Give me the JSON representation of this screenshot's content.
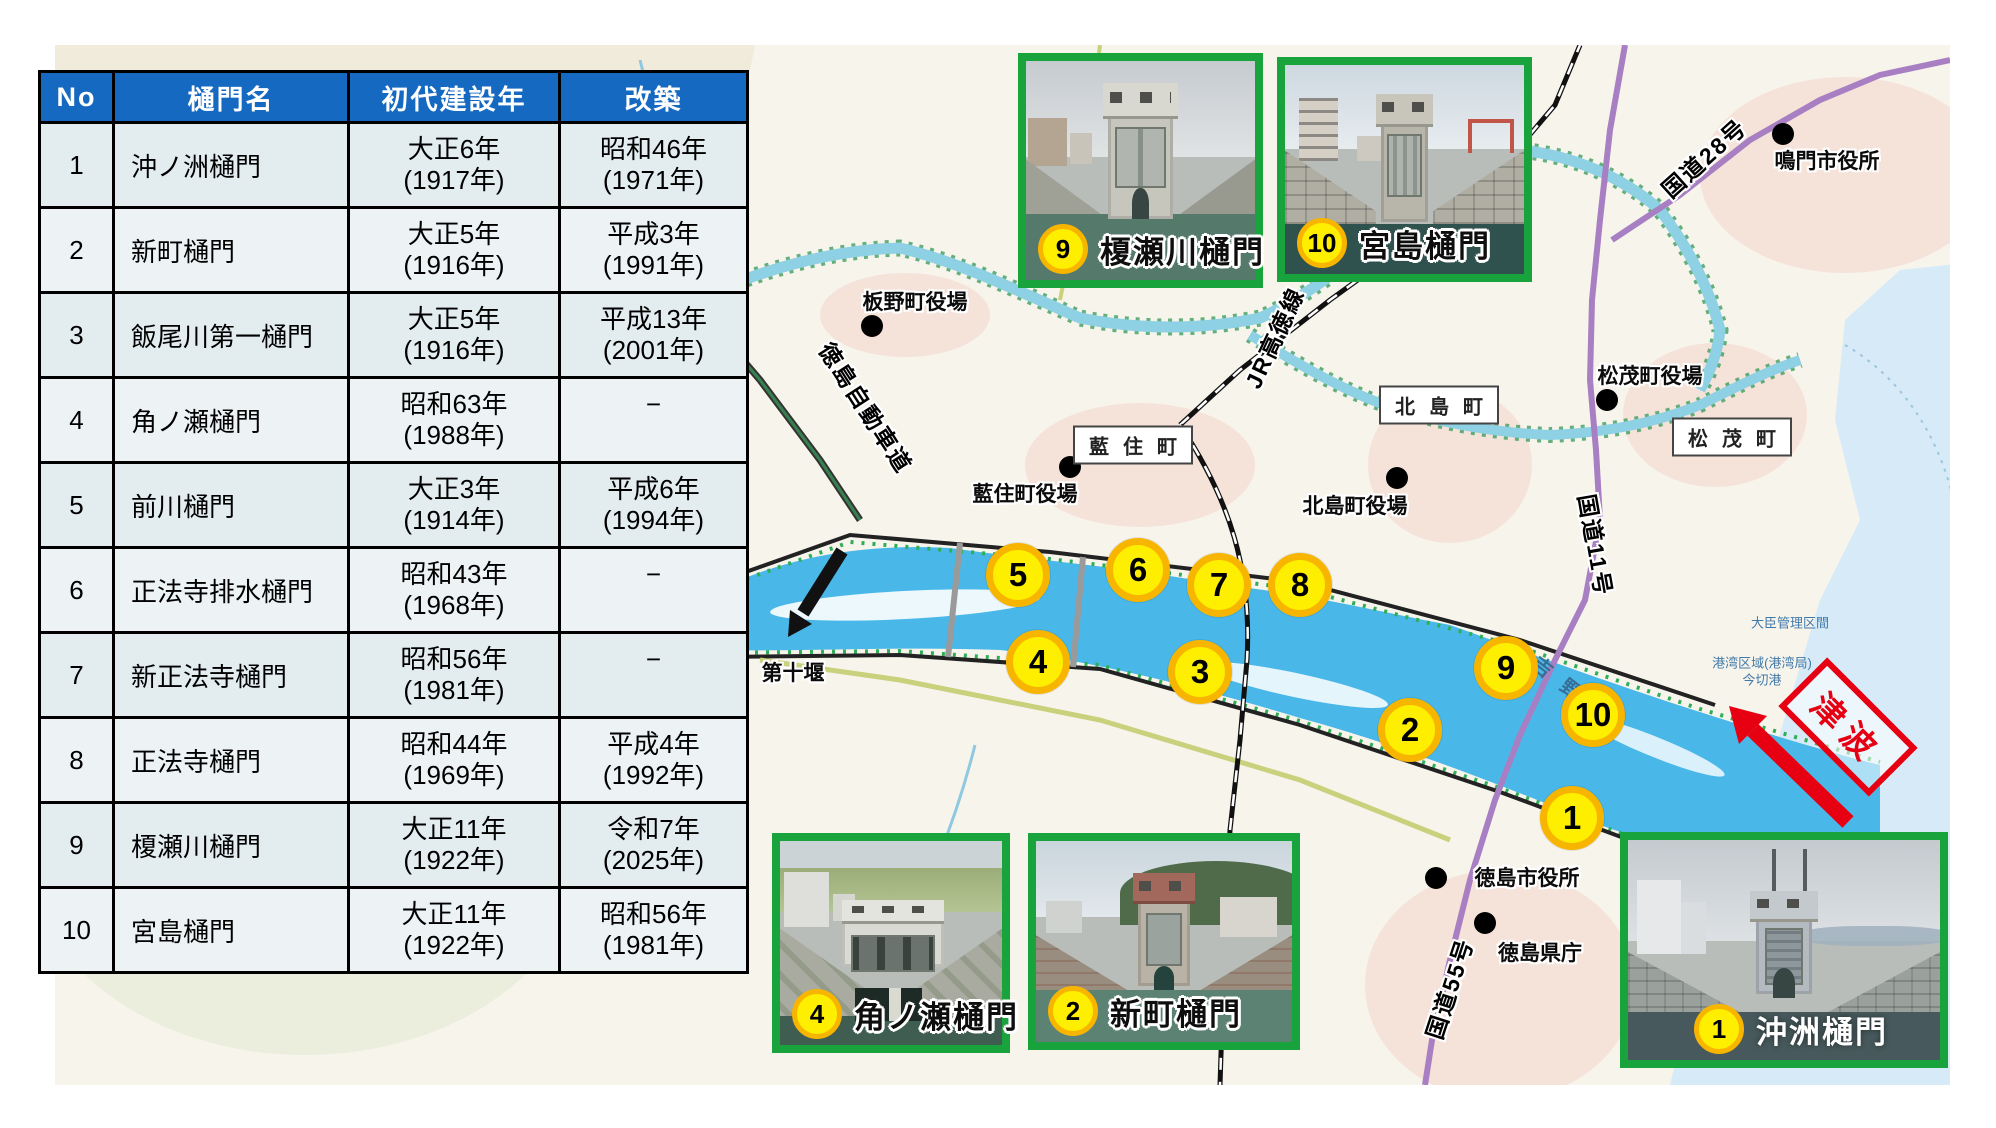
{
  "table": {
    "headers": [
      "No",
      "樋門名",
      "初代建設年",
      "改築"
    ],
    "rows": [
      {
        "no": "1",
        "name": "沖ノ洲樋門",
        "built1": "大正6年",
        "built2": "(1917年)",
        "rebuilt1": "昭和46年",
        "rebuilt2": "(1971年)"
      },
      {
        "no": "2",
        "name": "新町樋門",
        "built1": "大正5年",
        "built2": "(1916年)",
        "rebuilt1": "平成3年",
        "rebuilt2": "(1991年)"
      },
      {
        "no": "3",
        "name": "飯尾川第一樋門",
        "built1": "大正5年",
        "built2": "(1916年)",
        "rebuilt1": "平成13年",
        "rebuilt2": "(2001年)"
      },
      {
        "no": "4",
        "name": "角ノ瀬樋門",
        "built1": "昭和63年",
        "built2": "(1988年)",
        "rebuilt1": "−",
        "rebuilt2": ""
      },
      {
        "no": "5",
        "name": "前川樋門",
        "built1": "大正3年",
        "built2": "(1914年)",
        "rebuilt1": "平成6年",
        "rebuilt2": "(1994年)"
      },
      {
        "no": "6",
        "name": "正法寺排水樋門",
        "built1": "昭和43年",
        "built2": "(1968年)",
        "rebuilt1": "−",
        "rebuilt2": ""
      },
      {
        "no": "7",
        "name": "新正法寺樋門",
        "built1": "昭和56年",
        "built2": "(1981年)",
        "rebuilt1": "−",
        "rebuilt2": ""
      },
      {
        "no": "8",
        "name": "正法寺樋門",
        "built1": "昭和44年",
        "built2": "(1969年)",
        "rebuilt1": "平成4年",
        "rebuilt2": "(1992年)"
      },
      {
        "no": "9",
        "name": "榎瀬川樋門",
        "built1": "大正11年",
        "built2": "(1922年)",
        "rebuilt1": "令和7年",
        "rebuilt2": "(2025年)"
      },
      {
        "no": "10",
        "name": "宮島樋門",
        "built1": "大正11年",
        "built2": "(1922年)",
        "rebuilt1": "昭和56年",
        "rebuilt2": "(1981年)"
      }
    ]
  },
  "map": {
    "markers": [
      {
        "no": "5",
        "x": 1018,
        "y": 575
      },
      {
        "no": "6",
        "x": 1138,
        "y": 570
      },
      {
        "no": "7",
        "x": 1219,
        "y": 585
      },
      {
        "no": "8",
        "x": 1300,
        "y": 585
      },
      {
        "no": "4",
        "x": 1038,
        "y": 662
      },
      {
        "no": "3",
        "x": 1200,
        "y": 672
      },
      {
        "no": "2",
        "x": 1410,
        "y": 730
      },
      {
        "no": "9",
        "x": 1506,
        "y": 668
      },
      {
        "no": "10",
        "x": 1593,
        "y": 715
      },
      {
        "no": "1",
        "x": 1572,
        "y": 818
      }
    ],
    "place_labels": [
      {
        "text": "板野町役場",
        "x": 915,
        "y": 301,
        "dot_x": 872,
        "dot_y": 326
      },
      {
        "text": "藍住町役場",
        "x": 1025,
        "y": 493,
        "dot_x": 1070,
        "dot_y": 467
      },
      {
        "text": "北島町役場",
        "x": 1355,
        "y": 505,
        "dot_x": 1397,
        "dot_y": 478
      },
      {
        "text": "松茂町役場",
        "x": 1650,
        "y": 375,
        "dot_x": 1607,
        "dot_y": 400
      },
      {
        "text": "鳴門市役所",
        "x": 1827,
        "y": 160,
        "dot_x": 1783,
        "dot_y": 134
      },
      {
        "text": "徳島市役所",
        "x": 1527,
        "y": 877,
        "dot_x": 1436,
        "dot_y": 878
      },
      {
        "text": "徳島県庁",
        "x": 1540,
        "y": 952,
        "dot_x": 1485,
        "dot_y": 923
      },
      {
        "text": "第十堰",
        "x": 793,
        "y": 672
      }
    ],
    "boxed_labels": [
      {
        "text": "藍住町",
        "x": 1133,
        "y": 445
      },
      {
        "text": "北島町",
        "x": 1439,
        "y": 405
      },
      {
        "text": "松茂町",
        "x": 1732,
        "y": 437
      }
    ],
    "road_labels": [
      {
        "text": "徳島自動車道",
        "x": 867,
        "y": 407,
        "rot": 57
      },
      {
        "text": "JR高徳線",
        "x": 1273,
        "y": 337,
        "rot": -65
      },
      {
        "text": "国道28号",
        "x": 1703,
        "y": 157,
        "rot": -42
      },
      {
        "text": "国道11号",
        "x": 1597,
        "y": 545,
        "rot": 80
      },
      {
        "text": "国道55号",
        "x": 1448,
        "y": 988,
        "rot": -72
      }
    ],
    "river_label": {
      "text": "吉野川",
      "x": 1578,
      "y": 693,
      "rot": 38
    },
    "small_labels": [
      {
        "text": "大臣管理区間",
        "x": 1790,
        "y": 622
      },
      {
        "text": "港湾区域(港湾局)",
        "x": 1762,
        "y": 662
      },
      {
        "text": "今切港",
        "x": 1762,
        "y": 679
      }
    ],
    "tsunami": {
      "label": "津波",
      "x": 1848,
      "y": 727
    },
    "insets": [
      {
        "no": "9",
        "name": "榎瀬川樋門",
        "x": 1018,
        "y": 53,
        "w": 245,
        "h": 235,
        "variant": "v9",
        "caption": "outline"
      },
      {
        "no": "10",
        "name": "宮島樋門",
        "x": 1277,
        "y": 57,
        "w": 255,
        "h": 225,
        "variant": "v10",
        "caption": "outline"
      },
      {
        "no": "4",
        "name": "角ノ瀬樋門",
        "x": 772,
        "y": 833,
        "w": 238,
        "h": 220,
        "variant": "v4",
        "caption": "outline"
      },
      {
        "no": "2",
        "name": "新町樋門",
        "x": 1028,
        "y": 833,
        "w": 272,
        "h": 217,
        "variant": "v2",
        "caption": "outline"
      },
      {
        "no": "1",
        "name": "沖洲樋門",
        "x": 1620,
        "y": 832,
        "w": 328,
        "h": 236,
        "variant": "v1",
        "caption": "white",
        "cap_left": 66
      }
    ]
  },
  "colors": {
    "header_blue": "#1569c0",
    "cell_bg_odd": "#e3edf0",
    "cell_bg_even": "#edf3f5",
    "inset_green": "#18a33c",
    "marker_yellow": "#feee00",
    "marker_border": "#f8b500",
    "river_blue": "#49b8e9",
    "sea_blue": "#d6ebf7",
    "alert_red": "#e60012"
  }
}
